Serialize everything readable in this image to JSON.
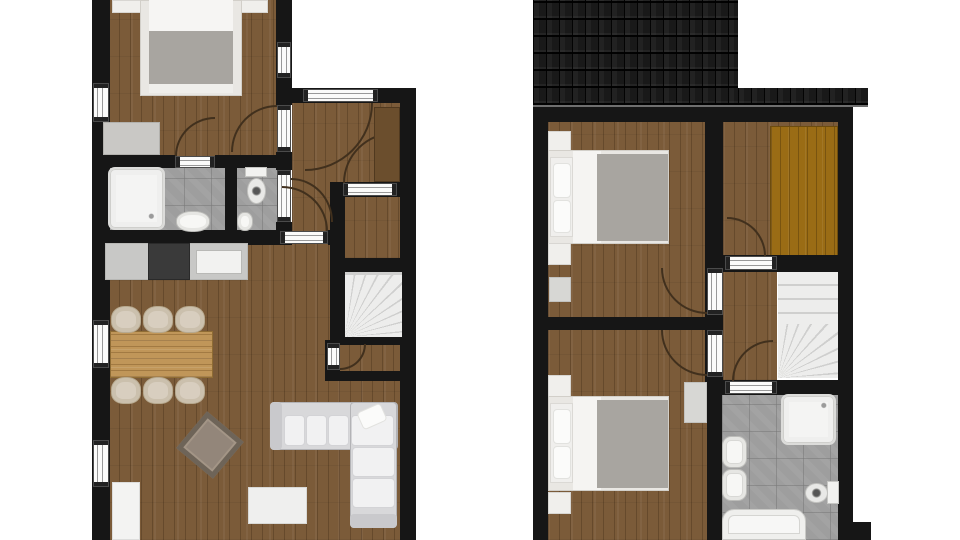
{
  "canvas": {
    "width": 960,
    "height": 540,
    "background": "#ffffff"
  },
  "palette": {
    "wall": "#161616",
    "wood_floor": "#7b5b39",
    "wardrobe_floor": "#9a6c15",
    "tile_floor": "#9e9e9e",
    "fixture_white": "#f4f4f3",
    "blanket_gray": "#a8a5a0",
    "counter_gray": "#c8c8c6",
    "stove_dark": "#3a3a3a",
    "roof_dark": "#191919"
  },
  "plans": {
    "left": "ground-floor",
    "right": "upper-floor"
  },
  "elements": [
    {
      "name": "ground-bedroom-floor",
      "cls": "floor-wood",
      "x": 108,
      "y": 0,
      "w": 170,
      "h": 168
    },
    {
      "name": "ground-hall-floor",
      "cls": "floor-wood",
      "x": 292,
      "y": 100,
      "w": 110,
      "h": 135
    },
    {
      "name": "ground-living-kitchen-floor",
      "cls": "floor-wood",
      "x": 108,
      "y": 240,
      "w": 294,
      "h": 300
    },
    {
      "name": "ground-storage-floor",
      "cls": "floor-wood",
      "x": 343,
      "y": 197,
      "w": 58,
      "h": 61
    },
    {
      "name": "ground-understair-floor",
      "cls": "floor-wood",
      "x": 338,
      "y": 343,
      "w": 64,
      "h": 30
    },
    {
      "name": "ground-bathroom-floor",
      "cls": "tile",
      "x": 103,
      "y": 163,
      "w": 124,
      "h": 70
    },
    {
      "name": "ground-wc-floor",
      "cls": "tile",
      "x": 235,
      "y": 163,
      "w": 43,
      "h": 70
    },
    {
      "name": "upper-bedroom2-floor",
      "cls": "floor-wood",
      "x": 548,
      "y": 122,
      "w": 160,
      "h": 198
    },
    {
      "name": "upper-bedroom3-floor",
      "cls": "floor-wood",
      "x": 548,
      "y": 328,
      "w": 160,
      "h": 212
    },
    {
      "name": "upper-closet-floor",
      "cls": "floor-wood",
      "x": 723,
      "y": 122,
      "w": 115,
      "h": 136
    },
    {
      "name": "upper-landing-floor",
      "cls": "floor-wood",
      "x": 723,
      "y": 257,
      "w": 54,
      "h": 123
    },
    {
      "name": "upper-bathroom-floor",
      "cls": "tile",
      "x": 722,
      "y": 393,
      "w": 116,
      "h": 147
    },
    {
      "name": "upper-wardrobe-floor",
      "cls": "floor-orange",
      "x": 770,
      "y": 126,
      "w": 68,
      "h": 130
    },
    {
      "name": "wall-left-exterior",
      "cls": "wall",
      "x": 92,
      "y": 0,
      "w": 18,
      "h": 540
    },
    {
      "name": "wall-bedroom-right-upper",
      "cls": "wall",
      "x": 276,
      "y": 0,
      "w": 16,
      "h": 105
    },
    {
      "name": "wall-bedroom-right-mid",
      "cls": "wall",
      "x": 276,
      "y": 152,
      "w": 16,
      "h": 18
    },
    {
      "name": "wall-bedroom-right-lower",
      "cls": "wall",
      "x": 276,
      "y": 222,
      "w": 16,
      "h": 23
    },
    {
      "name": "wall-entry-top",
      "cls": "wall",
      "x": 276,
      "y": 88,
      "w": 140,
      "h": 15
    },
    {
      "name": "wall-right-exterior",
      "cls": "wall",
      "x": 400,
      "y": 88,
      "w": 16,
      "h": 452
    },
    {
      "name": "wall-bedroom-bottom-left",
      "cls": "wall",
      "x": 92,
      "y": 155,
      "w": 83,
      "h": 13
    },
    {
      "name": "wall-bedroom-bottom-right",
      "cls": "wall",
      "x": 215,
      "y": 155,
      "w": 77,
      "h": 13
    },
    {
      "name": "wall-bath-wc-divider",
      "cls": "wall",
      "x": 225,
      "y": 155,
      "w": 12,
      "h": 90
    },
    {
      "name": "wall-kitchen-top-left",
      "cls": "wall",
      "x": 92,
      "y": 230,
      "w": 188,
      "h": 15
    },
    {
      "name": "wall-kitchen-top-right",
      "cls": "wall",
      "x": 328,
      "y": 230,
      "w": 17,
      "h": 15
    },
    {
      "name": "wall-storage-left",
      "cls": "wall",
      "x": 330,
      "y": 182,
      "w": 15,
      "h": 163
    },
    {
      "name": "wall-storage-top",
      "cls": "wall",
      "x": 337,
      "y": 182,
      "w": 79,
      "h": 15
    },
    {
      "name": "wall-stairs-top",
      "cls": "wall",
      "x": 330,
      "y": 258,
      "w": 86,
      "h": 14
    },
    {
      "name": "wall-stairs-bottom",
      "cls": "wall",
      "x": 330,
      "y": 337,
      "w": 86,
      "h": 8
    },
    {
      "name": "wall-understair-bottom",
      "cls": "wall",
      "x": 325,
      "y": 371,
      "w": 91,
      "h": 10
    },
    {
      "name": "wall-understair-left",
      "cls": "wall",
      "x": 325,
      "y": 340,
      "w": 15,
      "h": 41
    },
    {
      "name": "wall-upper-top",
      "cls": "wall",
      "x": 533,
      "y": 107,
      "w": 320,
      "h": 15
    },
    {
      "name": "wall-upper-left",
      "cls": "wall",
      "x": 533,
      "y": 107,
      "w": 15,
      "h": 433
    },
    {
      "name": "wall-upper-right",
      "cls": "wall",
      "x": 838,
      "y": 107,
      "w": 15,
      "h": 433
    },
    {
      "name": "wall-bedroom-divider",
      "cls": "wall",
      "x": 548,
      "y": 317,
      "w": 159,
      "h": 13
    },
    {
      "name": "wall-upper-hall",
      "cls": "wall",
      "x": 705,
      "y": 122,
      "w": 18,
      "h": 273
    },
    {
      "name": "wall-closet-bottom",
      "cls": "wall",
      "x": 723,
      "y": 255,
      "w": 115,
      "h": 17
    },
    {
      "name": "wall-upper-bath-top",
      "cls": "wall",
      "x": 707,
      "y": 380,
      "w": 146,
      "h": 15
    },
    {
      "name": "wall-upper-bath-left",
      "cls": "wall",
      "x": 707,
      "y": 395,
      "w": 15,
      "h": 145
    },
    {
      "name": "wall-step-bottom-right",
      "cls": "wall",
      "x": 848,
      "y": 522,
      "w": 23,
      "h": 18
    },
    {
      "name": "ground-stairs",
      "cls": "stairs-fan",
      "x": 345,
      "y": 272,
      "w": 57,
      "h": 65
    },
    {
      "name": "upper-stairs",
      "cls": "stairs-straight",
      "x": 778,
      "y": 272,
      "w": 60,
      "h": 106
    },
    {
      "name": "upper-stairs-winders",
      "cls": "stairs-fan2",
      "x": 778,
      "y": 324,
      "w": 60,
      "h": 54
    },
    {
      "name": "window-bedroom-left",
      "cls": "win-v",
      "x": 93,
      "y": 83,
      "w": 16,
      "h": 39
    },
    {
      "name": "window-dining-left",
      "cls": "win-v",
      "x": 93,
      "y": 320,
      "w": 16,
      "h": 48
    },
    {
      "name": "window-living-left",
      "cls": "win-v",
      "x": 93,
      "y": 440,
      "w": 16,
      "h": 47
    },
    {
      "name": "window-bedroom-right",
      "cls": "win-v",
      "x": 277,
      "y": 42,
      "w": 14,
      "h": 36
    },
    {
      "name": "door-front",
      "cls": "open-h",
      "x": 303,
      "y": 89,
      "w": 75,
      "h": 13
    },
    {
      "name": "door-bedroom",
      "cls": "open-v",
      "x": 277,
      "y": 105,
      "w": 14,
      "h": 47
    },
    {
      "name": "door-bathroom",
      "cls": "open-h",
      "x": 175,
      "y": 156,
      "w": 40,
      "h": 12
    },
    {
      "name": "door-wc",
      "cls": "open-v",
      "x": 277,
      "y": 170,
      "w": 14,
      "h": 52
    },
    {
      "name": "door-kitchen-hall",
      "cls": "open-h",
      "x": 280,
      "y": 231,
      "w": 48,
      "h": 13
    },
    {
      "name": "door-storage",
      "cls": "open-h",
      "x": 343,
      "y": 183,
      "w": 54,
      "h": 13
    },
    {
      "name": "door-understair",
      "cls": "open-v",
      "x": 327,
      "y": 343,
      "w": 13,
      "h": 27
    },
    {
      "name": "door-upper-bedroom2",
      "cls": "open-v",
      "x": 707,
      "y": 268,
      "w": 16,
      "h": 47
    },
    {
      "name": "door-upper-bedroom3",
      "cls": "open-v",
      "x": 707,
      "y": 330,
      "w": 16,
      "h": 47
    },
    {
      "name": "door-upper-closet",
      "cls": "open-h",
      "x": 725,
      "y": 256,
      "w": 52,
      "h": 14
    },
    {
      "name": "door-upper-bathroom",
      "cls": "open-h",
      "x": 725,
      "y": 381,
      "w": 52,
      "h": 13
    },
    {
      "name": "door-arc-front",
      "cls": "arc arc-c-tl",
      "x": 305,
      "y": 103,
      "w": 68,
      "h": 68
    },
    {
      "name": "door-arc-bedroom",
      "cls": "arc arc-c-br",
      "x": 231,
      "y": 105,
      "w": 46,
      "h": 47
    },
    {
      "name": "door-arc-bathroom",
      "cls": "arc arc-c-br",
      "x": 175,
      "y": 117,
      "w": 40,
      "h": 39
    },
    {
      "name": "door-arc-wc",
      "cls": "arc arc-c-bl",
      "x": 291,
      "y": 178,
      "w": 42,
      "h": 44
    },
    {
      "name": "door-arc-kitchen-hall",
      "cls": "arc arc-c-bl",
      "x": 282,
      "y": 186,
      "w": 46,
      "h": 45
    },
    {
      "name": "door-arc-storage",
      "cls": "arc arc-c-br",
      "x": 343,
      "y": 132,
      "w": 52,
      "h": 51
    },
    {
      "name": "door-arc-understair",
      "cls": "arc arc-c-tl",
      "x": 340,
      "y": 344,
      "w": 26,
      "h": 26
    },
    {
      "name": "door-arc-upper-bedroom2",
      "cls": "arc arc-c-tr",
      "x": 661,
      "y": 268,
      "w": 46,
      "h": 46
    },
    {
      "name": "door-arc-upper-bedroom3",
      "cls": "arc arc-c-tr",
      "x": 661,
      "y": 330,
      "w": 46,
      "h": 46
    },
    {
      "name": "door-arc-upper-closet",
      "cls": "arc arc-c-bl",
      "x": 727,
      "y": 217,
      "w": 39,
      "h": 39
    },
    {
      "name": "door-arc-upper-bathroom",
      "cls": "arc arc-c-br",
      "x": 732,
      "y": 340,
      "w": 41,
      "h": 41
    },
    {
      "name": "nightstand",
      "cls": "",
      "x": 112,
      "y": 0,
      "w": 38,
      "h": 13,
      "fill": "#f0efec",
      "border": "#d8d6d2"
    },
    {
      "name": "nightstand",
      "cls": "",
      "x": 231,
      "y": 0,
      "w": 37,
      "h": 13,
      "fill": "#f0efec",
      "border": "#d8d6d2"
    },
    {
      "name": "bed-frame",
      "cls": "",
      "x": 140,
      "y": 0,
      "w": 102,
      "h": 96,
      "fill": "#e9e7e3",
      "border": "#d2cfc9"
    },
    {
      "name": "bed-sheet",
      "cls": "",
      "x": 149,
      "y": 0,
      "w": 84,
      "h": 34,
      "fill": "#f6f5f3"
    },
    {
      "name": "bed-blanket",
      "cls": "",
      "x": 149,
      "y": 31,
      "w": 84,
      "h": 55,
      "fill": "#a8a5a0"
    },
    {
      "name": "bed-foot-fold",
      "cls": "",
      "x": 149,
      "y": 84,
      "w": 84,
      "h": 9,
      "fill": "#efeeeb"
    },
    {
      "name": "bedroom-dresser",
      "cls": "",
      "x": 103,
      "y": 122,
      "w": 57,
      "h": 33,
      "fill": "#c9c8c5",
      "border": "#b2b1ad"
    },
    {
      "name": "shower-tray",
      "cls": "shower",
      "x": 108,
      "y": 167,
      "w": 57,
      "h": 63
    },
    {
      "name": "bathroom-sink",
      "cls": "sink",
      "x": 176,
      "y": 211,
      "w": 34,
      "h": 21
    },
    {
      "name": "wc-toilet-tank",
      "cls": "",
      "x": 245,
      "y": 167,
      "w": 22,
      "h": 10,
      "fill": "#f2f2f0",
      "border": "#c6c6c3"
    },
    {
      "name": "wc-toilet-bowl",
      "cls": "toilet-bowl",
      "x": 247,
      "y": 178,
      "w": 19,
      "h": 26
    },
    {
      "name": "wc-sink",
      "cls": "sink",
      "x": 237,
      "y": 212,
      "w": 16,
      "h": 19
    },
    {
      "name": "hall-wardrobe",
      "cls": "",
      "x": 374,
      "y": 107,
      "w": 26,
      "h": 75,
      "fill": "#6b4e2d",
      "border": "#50391f"
    },
    {
      "name": "kitchen-counter",
      "cls": "",
      "x": 105,
      "y": 243,
      "w": 143,
      "h": 37,
      "fill": "#c8c8c6",
      "border": "#b7b7b4"
    },
    {
      "name": "kitchen-stove",
      "cls": "",
      "x": 148,
      "y": 243,
      "w": 42,
      "h": 37,
      "fill": "#3a3a3a",
      "border": "#2a2a2a"
    },
    {
      "name": "kitchen-sink-basin",
      "cls": "",
      "x": 196,
      "y": 250,
      "w": 46,
      "h": 24,
      "fill": "#f2f2f0",
      "border": "#b9b9b6"
    },
    {
      "name": "dining-table",
      "cls": "table-wood",
      "x": 110,
      "y": 331,
      "w": 103,
      "h": 47
    },
    {
      "name": "dining-chair",
      "cls": "chair",
      "x": 111,
      "y": 306,
      "w": 30,
      "h": 27
    },
    {
      "name": "dining-chair",
      "cls": "chair",
      "x": 143,
      "y": 306,
      "w": 30,
      "h": 27
    },
    {
      "name": "dining-chair",
      "cls": "chair",
      "x": 175,
      "y": 306,
      "w": 30,
      "h": 27
    },
    {
      "name": "dining-chair",
      "cls": "chair",
      "x": 111,
      "y": 377,
      "w": 30,
      "h": 27
    },
    {
      "name": "dining-chair",
      "cls": "chair",
      "x": 143,
      "y": 377,
      "w": 30,
      "h": 27
    },
    {
      "name": "dining-chair",
      "cls": "chair",
      "x": 175,
      "y": 377,
      "w": 30,
      "h": 27
    },
    {
      "name": "coffee-table",
      "cls": "coffee",
      "x": 186,
      "y": 421,
      "w": 48,
      "h": 48,
      "rotate": 40
    },
    {
      "name": "tv-stand",
      "cls": "",
      "x": 248,
      "y": 487,
      "w": 59,
      "h": 37,
      "fill": "#efefee",
      "border": "#d9d9d6"
    },
    {
      "name": "sideboard",
      "cls": "",
      "x": 112,
      "y": 482,
      "w": 28,
      "h": 58,
      "fill": "#f3f3f2",
      "border": "#dddddc"
    },
    {
      "name": "sofa-base-horizontal",
      "cls": "sofa",
      "x": 270,
      "y": 402,
      "w": 128,
      "h": 48
    },
    {
      "name": "sofa-base-vertical",
      "cls": "sofa",
      "x": 350,
      "y": 402,
      "w": 47,
      "h": 126
    },
    {
      "name": "sofa-armrest",
      "cls": "",
      "x": 270,
      "y": 402,
      "w": 12,
      "h": 48,
      "fill": "#c9c9cc",
      "radius": "4px"
    },
    {
      "name": "sofa-armrest",
      "cls": "",
      "x": 350,
      "y": 514,
      "w": 47,
      "h": 14,
      "fill": "#c9c9cc",
      "radius": "4px"
    },
    {
      "name": "sofa-cushion",
      "cls": "cushion",
      "x": 284,
      "y": 415,
      "w": 21,
      "h": 31
    },
    {
      "name": "sofa-cushion",
      "cls": "cushion",
      "x": 306,
      "y": 415,
      "w": 21,
      "h": 31
    },
    {
      "name": "sofa-cushion",
      "cls": "cushion",
      "x": 328,
      "y": 415,
      "w": 21,
      "h": 31
    },
    {
      "name": "sofa-cushion",
      "cls": "cushion",
      "x": 351,
      "y": 415,
      "w": 43,
      "h": 31
    },
    {
      "name": "sofa-cushion",
      "cls": "cushion",
      "x": 352,
      "y": 447,
      "w": 43,
      "h": 30
    },
    {
      "name": "sofa-cushion",
      "cls": "cushion",
      "x": 352,
      "y": 478,
      "w": 43,
      "h": 30
    },
    {
      "name": "sofa-pillow",
      "cls": "pillow",
      "x": 359,
      "y": 407,
      "w": 26,
      "h": 19,
      "rotate": -24
    },
    {
      "name": "nightstand",
      "cls": "",
      "x": 548,
      "y": 131,
      "w": 23,
      "h": 21,
      "fill": "#f0efec",
      "border": "#d8d6d2"
    },
    {
      "name": "bed-frame",
      "cls": "",
      "x": 548,
      "y": 150,
      "w": 121,
      "h": 94,
      "fill": "#e9e7e3",
      "border": "#d2cfc9"
    },
    {
      "name": "bed-headboard",
      "cls": "",
      "x": 550,
      "y": 157,
      "w": 23,
      "h": 80,
      "fill": "#f0efed",
      "border": "#dbd9d5"
    },
    {
      "name": "bed-pillow",
      "cls": "pillow",
      "x": 553,
      "y": 163,
      "w": 18,
      "h": 35
    },
    {
      "name": "bed-pillow",
      "cls": "pillow",
      "x": 553,
      "y": 200,
      "w": 18,
      "h": 33
    },
    {
      "name": "bed-sheet",
      "cls": "",
      "x": 573,
      "y": 151,
      "w": 28,
      "h": 92,
      "fill": "#f5f4f2"
    },
    {
      "name": "bed-blanket",
      "cls": "",
      "x": 597,
      "y": 154,
      "w": 71,
      "h": 87,
      "fill": "#a8a5a0"
    },
    {
      "name": "nightstand",
      "cls": "",
      "x": 548,
      "y": 243,
      "w": 23,
      "h": 22,
      "fill": "#f0efec",
      "border": "#d8d6d2"
    },
    {
      "name": "bedroom2-dresser",
      "cls": "",
      "x": 549,
      "y": 277,
      "w": 22,
      "h": 25,
      "fill": "#d7d7d4",
      "border": "#c2c2bf"
    },
    {
      "name": "nightstand",
      "cls": "",
      "x": 548,
      "y": 375,
      "w": 23,
      "h": 22,
      "fill": "#f0efec",
      "border": "#d8d6d2"
    },
    {
      "name": "bed-frame",
      "cls": "",
      "x": 548,
      "y": 396,
      "w": 121,
      "h": 95,
      "fill": "#e9e7e3",
      "border": "#d2cfc9"
    },
    {
      "name": "bed-headboard",
      "cls": "",
      "x": 550,
      "y": 403,
      "w": 23,
      "h": 80,
      "fill": "#f0efed",
      "border": "#dbd9d5"
    },
    {
      "name": "bed-pillow",
      "cls": "pillow",
      "x": 553,
      "y": 409,
      "w": 18,
      "h": 35
    },
    {
      "name": "bed-pillow",
      "cls": "pillow",
      "x": 553,
      "y": 446,
      "w": 18,
      "h": 33
    },
    {
      "name": "bed-sheet",
      "cls": "",
      "x": 573,
      "y": 397,
      "w": 28,
      "h": 93,
      "fill": "#f5f4f2"
    },
    {
      "name": "bed-blanket",
      "cls": "",
      "x": 597,
      "y": 400,
      "w": 71,
      "h": 88,
      "fill": "#a8a5a0"
    },
    {
      "name": "nightstand",
      "cls": "",
      "x": 548,
      "y": 492,
      "w": 23,
      "h": 22,
      "fill": "#f0efec",
      "border": "#d8d6d2"
    },
    {
      "name": "bedroom3-dresser",
      "cls": "",
      "x": 684,
      "y": 382,
      "w": 23,
      "h": 41,
      "fill": "#d7d7d4",
      "border": "#c2c2bf"
    },
    {
      "name": "upper-shower-tray",
      "cls": "shower-r",
      "x": 781,
      "y": 394,
      "w": 55,
      "h": 51
    },
    {
      "name": "upper-bathroom-sink",
      "cls": "sink-rect",
      "x": 722,
      "y": 436,
      "w": 25,
      "h": 32
    },
    {
      "name": "upper-bathroom-sink",
      "cls": "sink-rect",
      "x": 722,
      "y": 469,
      "w": 25,
      "h": 32
    },
    {
      "name": "upper-toilet-tank",
      "cls": "",
      "x": 827,
      "y": 481,
      "w": 12,
      "h": 23,
      "fill": "#f2f2f0",
      "border": "#c6c6c3"
    },
    {
      "name": "upper-toilet-bowl",
      "cls": "toilet-bowl",
      "x": 805,
      "y": 483,
      "w": 23,
      "h": 20
    },
    {
      "name": "bathtub",
      "cls": "tub",
      "x": 722,
      "y": 509,
      "w": 84,
      "h": 31
    },
    {
      "name": "roof-main",
      "cls": "roof",
      "x": 533,
      "y": 0,
      "w": 205,
      "h": 107
    },
    {
      "name": "roof-eave-strip",
      "cls": "roof",
      "x": 738,
      "y": 88,
      "w": 130,
      "h": 19
    }
  ]
}
